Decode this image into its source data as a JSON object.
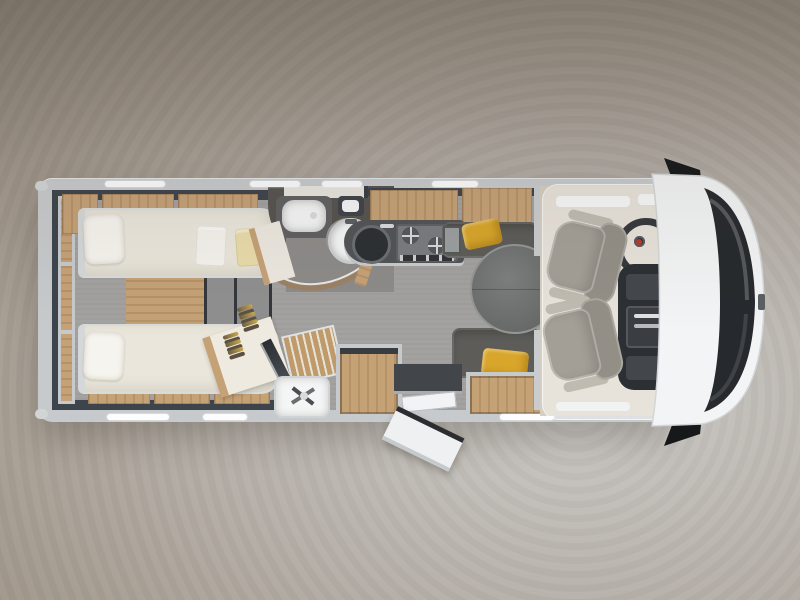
{
  "scene": {
    "type": "3d-floorplan-render",
    "subject": "Motorhome interior floor plan, top view",
    "orientation": "Vehicle front (cab) on the right, rear bedroom on the left"
  },
  "palette": {
    "bg-center": "#cbc9c6",
    "bg-mid": "#b5afa8",
    "bg-edge": "#a0968a",
    "bg-dark": "#8b8278",
    "body": "#c7cacc",
    "body-light": "#f2f3f4",
    "wall-dark": "#3e444c",
    "wood": "#c5a176",
    "bed": "#eae6db",
    "pillow": "#f6f4ee",
    "floor": "#a3a2a0",
    "floor-dark": "#8d8b89",
    "step": "#8f8f8f",
    "step-frame": "#33363a",
    "sofa": "#5d5c58",
    "accent": "#d8a62b",
    "counter": "#515355",
    "hob": "#797c7f",
    "bath-wall": "#565350",
    "bronze": "#9b8165",
    "seat": "#a39f96",
    "seat-dark": "#938f86",
    "seat-light": "#bfbbb1",
    "dash": "#2c2f33",
    "glassy": "#26292d",
    "cab-floor": "#d6cec0",
    "chrome": "#d9dadb",
    "white": "#f4f5f5"
  },
  "areas": [
    {
      "id": "rear-bedroom",
      "label": "Rear bedroom with twin single beds"
    },
    {
      "id": "bedroom-steps",
      "label": "Central steps between the twin beds"
    },
    {
      "id": "wardrobe",
      "label": "Wardrobe with clothes hangers"
    },
    {
      "id": "washroom",
      "label": "Washroom with basin and swivel toilet"
    },
    {
      "id": "shower",
      "label": "Shower with slatted teak floor"
    },
    {
      "id": "kitchen",
      "label": "Kitchen with round sink and two-burner hob"
    },
    {
      "id": "dinette",
      "label": "Dinette with round table and facing sofas"
    },
    {
      "id": "entrance",
      "label": "Entrance with open door and step"
    },
    {
      "id": "cab",
      "label": "Driver cab with two swivelled seats"
    },
    {
      "id": "front-end",
      "label": "Front end with windscreen and mirrors"
    }
  ],
  "furniture": {
    "beds": 2,
    "pillows": 2,
    "towels_on_bed": 2,
    "overhead_lockers": 7,
    "window_strips": 6,
    "sofas": 2,
    "yellow_cushions": 3,
    "round_table": 1,
    "cab_seats": 2,
    "steering_wheel": 1,
    "side_mirrors": 2,
    "toilet": 1,
    "washbasin": 1,
    "kitchen_sink": 1,
    "hob_burners": 2
  }
}
